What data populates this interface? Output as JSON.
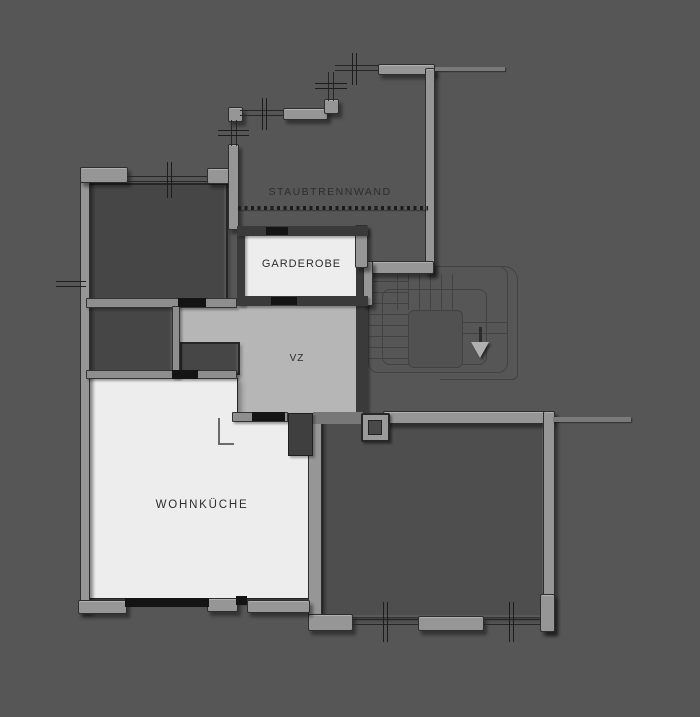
{
  "plan": {
    "type": "architectural-floor-plan",
    "background": "#565656",
    "labels": {
      "dust_partition": "STAUBTRENNWAND",
      "garderobe": "GARDEROBE",
      "vestibule": "VZ",
      "kitchen": "WOHNKÜCHE"
    },
    "colors": {
      "wall_light": "#969696",
      "wall_dark": "#3a3a3a",
      "room_white": "#ededed",
      "room_light_gray": "#b6b6b6",
      "room_dark": "#464646",
      "door_mark": "#141414",
      "line": "#262626",
      "text": "#2d2d2d"
    },
    "partition_line_style": "dotted",
    "stair": {
      "arrow_direction": "down"
    }
  }
}
